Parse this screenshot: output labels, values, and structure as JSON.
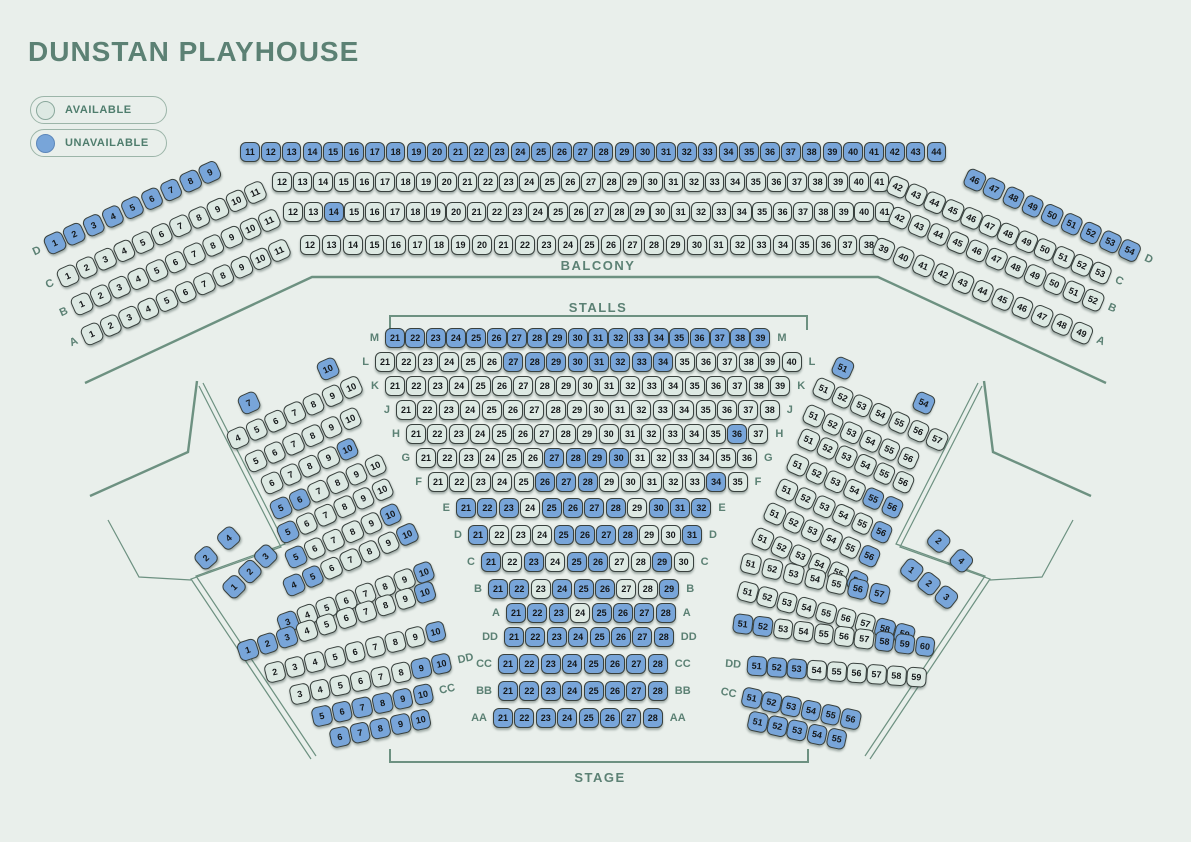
{
  "title": "DUNSTAN PLAYHOUSE",
  "legend": {
    "available": "AVAILABLE",
    "unavailable": "UNAVAILABLE"
  },
  "sections": {
    "balcony": "BALCONY",
    "stalls": "STALLS",
    "stage": "STAGE"
  },
  "colors": {
    "background": "#e9efeb",
    "seat_available": "#dde9e3",
    "seat_unavailable": "#78a5d9",
    "seat_outline": "#39413e",
    "accent_green": "#5c8174",
    "line_green": "#6d9181"
  },
  "strips": [
    {
      "n": "balcony-left-D",
      "row": "D",
      "x": 55,
      "y": 243,
      "a": -24.5,
      "p": 21.3,
      "s": 19.5,
      "r": [
        1,
        9
      ],
      "u": "all",
      "lab": "before"
    },
    {
      "n": "balcony-mid-D",
      "row": "D",
      "x": 250,
      "y": 152,
      "a": 0,
      "p": 20.8,
      "s": 19.5,
      "r": [
        11,
        44
      ],
      "u": "all",
      "lab": "none"
    },
    {
      "n": "balcony-right-D",
      "row": "D",
      "x": 975,
      "y": 180,
      "a": 24.5,
      "p": 21.3,
      "s": 19.5,
      "r": [
        46,
        54
      ],
      "u": "all",
      "lab": "after"
    },
    {
      "n": "balcony-left-C",
      "row": "C",
      "x": 68,
      "y": 276,
      "a": -24,
      "p": 20.5,
      "s": 19.5,
      "r": [
        1,
        11
      ],
      "u": [],
      "lab": "before"
    },
    {
      "n": "balcony-mid-C",
      "row": "C",
      "x": 282,
      "y": 182,
      "a": 0,
      "p": 20.6,
      "s": 19.5,
      "r": [
        12,
        41
      ],
      "u": [],
      "lab": "none"
    },
    {
      "n": "balcony-right-C",
      "row": "C",
      "x": 898,
      "y": 187,
      "a": 23,
      "p": 20,
      "s": 19.5,
      "r": [
        42,
        53
      ],
      "u": [],
      "lab": "after"
    },
    {
      "n": "balcony-left-B",
      "row": "B",
      "x": 82,
      "y": 304,
      "a": -24,
      "p": 20.5,
      "s": 19.5,
      "r": [
        1,
        11
      ],
      "u": [],
      "lab": "before"
    },
    {
      "n": "balcony-mid-B",
      "row": "B",
      "x": 293,
      "y": 212,
      "a": 0,
      "p": 20.4,
      "s": 19.5,
      "r": [
        12,
        41
      ],
      "u": [
        14
      ],
      "lab": "none"
    },
    {
      "n": "balcony-right-B",
      "row": "B",
      "x": 900,
      "y": 218,
      "a": 23,
      "p": 21,
      "s": 19.5,
      "r": [
        42,
        52
      ],
      "u": [],
      "lab": "after"
    },
    {
      "n": "balcony-left-A",
      "row": "A",
      "x": 92,
      "y": 334,
      "a": -24,
      "p": 20.5,
      "s": 19.5,
      "r": [
        1,
        11
      ],
      "u": [],
      "lab": "before"
    },
    {
      "n": "balcony-mid-A",
      "row": "A",
      "x": 310,
      "y": 245,
      "a": 0,
      "p": 21.5,
      "s": 19.5,
      "r": [
        12,
        38
      ],
      "u": [],
      "lab": "none"
    },
    {
      "n": "balcony-right-A",
      "row": "A",
      "x": 884,
      "y": 249,
      "a": 23,
      "p": 21.5,
      "s": 19.5,
      "r": [
        39,
        49
      ],
      "u": [],
      "lab": "after"
    },
    {
      "n": "stalls-center-M",
      "row": "M",
      "x": 395,
      "y": 338,
      "a": 0,
      "p": 20.3,
      "s": 20,
      "r": [
        21,
        39
      ],
      "u": "all",
      "lab": "both"
    },
    {
      "n": "stalls-center-L",
      "row": "L",
      "x": 385,
      "y": 362,
      "a": 0,
      "p": 21.4,
      "s": 20,
      "r": [
        21,
        40
      ],
      "u": [
        27,
        28,
        29,
        30,
        31,
        32,
        33,
        34
      ],
      "lab": "both"
    },
    {
      "n": "stalls-center-K",
      "row": "K",
      "x": 395,
      "y": 386,
      "a": 0,
      "p": 21.4,
      "s": 20,
      "r": [
        21,
        39
      ],
      "u": [],
      "lab": "both"
    },
    {
      "n": "stalls-center-J",
      "row": "J",
      "x": 406,
      "y": 410,
      "a": 0,
      "p": 21.4,
      "s": 20,
      "r": [
        21,
        38
      ],
      "u": [],
      "lab": "both"
    },
    {
      "n": "stalls-center-H",
      "row": "H",
      "x": 416,
      "y": 434,
      "a": 0,
      "p": 21.4,
      "s": 20,
      "r": [
        21,
        37
      ],
      "u": [
        36
      ],
      "lab": "both"
    },
    {
      "n": "stalls-center-G",
      "row": "G",
      "x": 426,
      "y": 458,
      "a": 0,
      "p": 21.4,
      "s": 20,
      "r": [
        21,
        36
      ],
      "u": [
        27,
        28,
        29,
        30
      ],
      "lab": "both"
    },
    {
      "n": "stalls-center-F",
      "row": "F",
      "x": 438,
      "y": 482,
      "a": 0,
      "p": 21.4,
      "s": 20,
      "r": [
        21,
        35
      ],
      "u": [
        26,
        27,
        28,
        34
      ],
      "lab": "both"
    },
    {
      "n": "stalls-center-E",
      "row": "E",
      "x": 466,
      "y": 508,
      "a": 0,
      "p": 21.4,
      "s": 20,
      "r": [
        21,
        32
      ],
      "u": [
        21,
        22,
        23,
        25,
        26,
        27,
        28,
        30,
        31,
        32
      ],
      "lab": "both"
    },
    {
      "n": "stalls-center-D",
      "row": "D",
      "x": 478,
      "y": 535,
      "a": 0,
      "p": 21.4,
      "s": 20,
      "r": [
        21,
        31
      ],
      "u": [
        21,
        25,
        26,
        27,
        28,
        31
      ],
      "lab": "both"
    },
    {
      "n": "stalls-center-C",
      "row": "C",
      "x": 491,
      "y": 562,
      "a": 0,
      "p": 21.4,
      "s": 20,
      "r": [
        21,
        30
      ],
      "u": [
        21,
        23,
        25,
        26,
        29
      ],
      "lab": "both"
    },
    {
      "n": "stalls-center-B",
      "row": "B",
      "x": 498,
      "y": 589,
      "a": 0,
      "p": 21.4,
      "s": 20,
      "r": [
        21,
        29
      ],
      "u": [
        21,
        22,
        24,
        25,
        26,
        29
      ],
      "lab": "both"
    },
    {
      "n": "stalls-center-A",
      "row": "A",
      "x": 516,
      "y": 613,
      "a": 0,
      "p": 21.4,
      "s": 20,
      "r": [
        21,
        28
      ],
      "u": [
        21,
        22,
        23,
        25,
        26,
        27,
        28
      ],
      "lab": "both"
    },
    {
      "n": "stalls-center-DD",
      "row": "DD",
      "x": 514,
      "y": 637,
      "a": 0,
      "p": 21.4,
      "s": 20,
      "r": [
        21,
        28
      ],
      "u": "all",
      "lab": "both"
    },
    {
      "n": "stalls-center-CC",
      "row": "CC",
      "x": 508,
      "y": 664,
      "a": 0,
      "p": 21.4,
      "s": 20,
      "r": [
        21,
        28
      ],
      "u": "all",
      "lab": "both"
    },
    {
      "n": "stalls-center-BB",
      "row": "BB",
      "x": 508,
      "y": 691,
      "a": 0,
      "p": 21.4,
      "s": 20,
      "r": [
        21,
        28
      ],
      "u": "all",
      "lab": "both"
    },
    {
      "n": "stalls-center-AA",
      "row": "AA",
      "x": 503,
      "y": 718,
      "a": 0,
      "p": 21.4,
      "s": 20,
      "r": [
        21,
        28
      ],
      "u": "all",
      "lab": "both"
    },
    {
      "n": "stalls-left-L7",
      "row": "L",
      "x": 249,
      "y": 403,
      "a": -24,
      "p": 20.7,
      "s": 19.5,
      "r": [
        7,
        7
      ],
      "u": "all",
      "lab": "none"
    },
    {
      "n": "stalls-left-L10",
      "row": "L",
      "x": 328,
      "y": 369,
      "a": -24,
      "p": 20.7,
      "s": 19.5,
      "r": [
        10,
        10
      ],
      "u": "all",
      "lab": "none"
    },
    {
      "n": "stalls-left-K",
      "row": "K",
      "x": 238,
      "y": 438,
      "a": -24,
      "p": 20.7,
      "s": 19.5,
      "r": [
        4,
        10
      ],
      "u": [],
      "lab": "none"
    },
    {
      "n": "stalls-left-J",
      "row": "J",
      "x": 256,
      "y": 461,
      "a": -24,
      "p": 20.7,
      "s": 19.5,
      "r": [
        5,
        10
      ],
      "u": [],
      "lab": "none"
    },
    {
      "n": "stalls-left-H",
      "row": "H",
      "x": 272,
      "y": 483,
      "a": -24,
      "p": 20.7,
      "s": 19.5,
      "r": [
        6,
        10
      ],
      "u": [
        10
      ],
      "lab": "none"
    },
    {
      "n": "stalls-left-G",
      "row": "G",
      "x": 281,
      "y": 508,
      "a": -24,
      "p": 20.7,
      "s": 19.5,
      "r": [
        5,
        10
      ],
      "u": [
        5,
        6
      ],
      "lab": "none"
    },
    {
      "n": "stalls-left-F",
      "row": "F",
      "x": 288,
      "y": 532,
      "a": -24,
      "p": 20.7,
      "s": 19.5,
      "r": [
        5,
        10
      ],
      "u": [
        5
      ],
      "lab": "none"
    },
    {
      "n": "stalls-left-E",
      "row": "E",
      "x": 296,
      "y": 557,
      "a": -24,
      "p": 20.7,
      "s": 19.5,
      "r": [
        5,
        10
      ],
      "u": [
        5,
        10
      ],
      "lab": "none"
    },
    {
      "n": "stalls-left-D",
      "row": "D",
      "x": 294,
      "y": 585,
      "a": -24,
      "p": 20.7,
      "s": 19.5,
      "r": [
        4,
        10
      ],
      "u": [
        4,
        5,
        10
      ],
      "lab": "none"
    },
    {
      "n": "stalls-left-C",
      "row": "C",
      "x": 288,
      "y": 622,
      "a": -20,
      "p": 20.7,
      "s": 19.5,
      "r": [
        3,
        10
      ],
      "u": [
        3,
        10
      ],
      "lab": "none"
    },
    {
      "n": "stalls-left-B",
      "row": "B",
      "x": 248,
      "y": 650,
      "a": -18,
      "p": 20.7,
      "s": 19.5,
      "r": [
        1,
        10
      ],
      "u": [
        1,
        2,
        3,
        10
      ],
      "lab": "none"
    },
    {
      "n": "stalls-left-A",
      "row": "A",
      "x": 275,
      "y": 672,
      "a": -14,
      "p": 20.7,
      "s": 19.5,
      "r": [
        2,
        10
      ],
      "u": [
        10
      ],
      "lab": "none"
    },
    {
      "n": "stalls-left-DD",
      "row": "DD",
      "x": 300,
      "y": 694,
      "a": -12,
      "p": 20.7,
      "s": 19.5,
      "r": [
        3,
        10
      ],
      "u": [
        9,
        10
      ],
      "lab": "after"
    },
    {
      "n": "stalls-left-CC",
      "row": "CC",
      "x": 322,
      "y": 716,
      "a": -12,
      "p": 20.7,
      "s": 19.5,
      "r": [
        5,
        10
      ],
      "u": "all",
      "lab": "after"
    },
    {
      "n": "stalls-left-BB",
      "row": "BB",
      "x": 340,
      "y": 737,
      "a": -12,
      "p": 20.7,
      "s": 19.5,
      "r": [
        6,
        10
      ],
      "u": "all",
      "lab": "none"
    },
    {
      "n": "wing-left-upper",
      "row": "D",
      "x": 206,
      "y": 558,
      "a": -41,
      "p": 15.1,
      "s": 19.5,
      "seq": [
        2,
        null,
        4
      ],
      "u": "all",
      "lab": "none"
    },
    {
      "n": "wing-left-lower",
      "row": "C",
      "x": 234,
      "y": 587,
      "a": -44,
      "p": 22,
      "s": 19.5,
      "seq": [
        1,
        2,
        3
      ],
      "u": "all",
      "lab": "none"
    },
    {
      "n": "stalls-right-L51",
      "row": "L",
      "x": 843,
      "y": 368,
      "a": 24,
      "p": 20.7,
      "s": 19.5,
      "r": [
        51,
        51
      ],
      "u": "all",
      "lab": "none"
    },
    {
      "n": "stalls-right-L54",
      "row": "L",
      "x": 924,
      "y": 403,
      "a": 24,
      "p": 20.7,
      "s": 19.5,
      "r": [
        54,
        54
      ],
      "u": "all",
      "lab": "none"
    },
    {
      "n": "stalls-right-K",
      "row": "K",
      "x": 824,
      "y": 389,
      "a": 24,
      "p": 20.7,
      "s": 19.5,
      "r": [
        51,
        57
      ],
      "u": [],
      "lab": "none"
    },
    {
      "n": "stalls-right-J",
      "row": "J",
      "x": 814,
      "y": 416,
      "a": 24,
      "p": 20.7,
      "s": 19.5,
      "r": [
        51,
        56
      ],
      "u": [],
      "lab": "none"
    },
    {
      "n": "stalls-right-H",
      "row": "H",
      "x": 809,
      "y": 440,
      "a": 24,
      "p": 20.7,
      "s": 19.5,
      "r": [
        51,
        56
      ],
      "u": [],
      "lab": "none"
    },
    {
      "n": "stalls-right-G",
      "row": "G",
      "x": 798,
      "y": 465,
      "a": 24,
      "p": 20.7,
      "s": 19.5,
      "r": [
        51,
        56
      ],
      "u": [
        55,
        56
      ],
      "lab": "none"
    },
    {
      "n": "stalls-right-F",
      "row": "F",
      "x": 787,
      "y": 490,
      "a": 24,
      "p": 20.7,
      "s": 19.5,
      "r": [
        51,
        56
      ],
      "u": [
        56
      ],
      "lab": "none"
    },
    {
      "n": "stalls-right-E",
      "row": "E",
      "x": 775,
      "y": 514,
      "a": 24,
      "p": 20.7,
      "s": 19.5,
      "r": [
        51,
        56
      ],
      "u": [
        56
      ],
      "lab": "none"
    },
    {
      "n": "stalls-right-D",
      "row": "D",
      "x": 763,
      "y": 539,
      "a": 24,
      "p": 20.7,
      "s": 19.5,
      "r": [
        51,
        56
      ],
      "u": [
        56
      ],
      "lab": "none"
    },
    {
      "n": "stalls-right-C",
      "row": "C",
      "x": 751,
      "y": 564,
      "a": 13,
      "p": 22,
      "s": 19.5,
      "r": [
        51,
        57
      ],
      "u": [
        56,
        57
      ],
      "lab": "none"
    },
    {
      "n": "stalls-right-B",
      "row": "B",
      "x": 748,
      "y": 592,
      "a": 15,
      "p": 20.3,
      "s": 19.5,
      "r": [
        51,
        59
      ],
      "u": [
        58,
        59
      ],
      "lab": "none"
    },
    {
      "n": "stalls-right-A",
      "row": "A",
      "x": 743,
      "y": 624,
      "a": 7,
      "p": 20.4,
      "s": 19.5,
      "r": [
        51,
        60
      ],
      "u": [
        51,
        52,
        58,
        59,
        60
      ],
      "lab": "none"
    },
    {
      "n": "stalls-right-DD",
      "row": "DD",
      "x": 757,
      "y": 666,
      "a": 4,
      "p": 20,
      "s": 19.5,
      "r": [
        51,
        59
      ],
      "u": [
        51,
        52,
        53
      ],
      "lab": "before"
    },
    {
      "n": "stalls-right-CC",
      "row": "CC",
      "x": 752,
      "y": 698,
      "a": 12,
      "p": 20.2,
      "s": 19.5,
      "r": [
        51,
        56
      ],
      "u": "all",
      "lab": "before"
    },
    {
      "n": "stalls-right-BB",
      "row": "BB",
      "x": 758,
      "y": 722,
      "a": 12,
      "p": 20.2,
      "s": 19.5,
      "r": [
        51,
        55
      ],
      "u": "all",
      "lab": "none"
    },
    {
      "n": "wing-right-upper",
      "row": "D",
      "x": 939,
      "y": 541,
      "a": 41,
      "p": 15.1,
      "s": 19.5,
      "seq": [
        2,
        null,
        4
      ],
      "u": "all",
      "lab": "none"
    },
    {
      "n": "wing-right-lower",
      "row": "C",
      "x": 912,
      "y": 570,
      "a": 38,
      "p": 22,
      "s": 19.5,
      "seq": [
        1,
        2,
        3
      ],
      "u": "all",
      "lab": "none"
    }
  ]
}
